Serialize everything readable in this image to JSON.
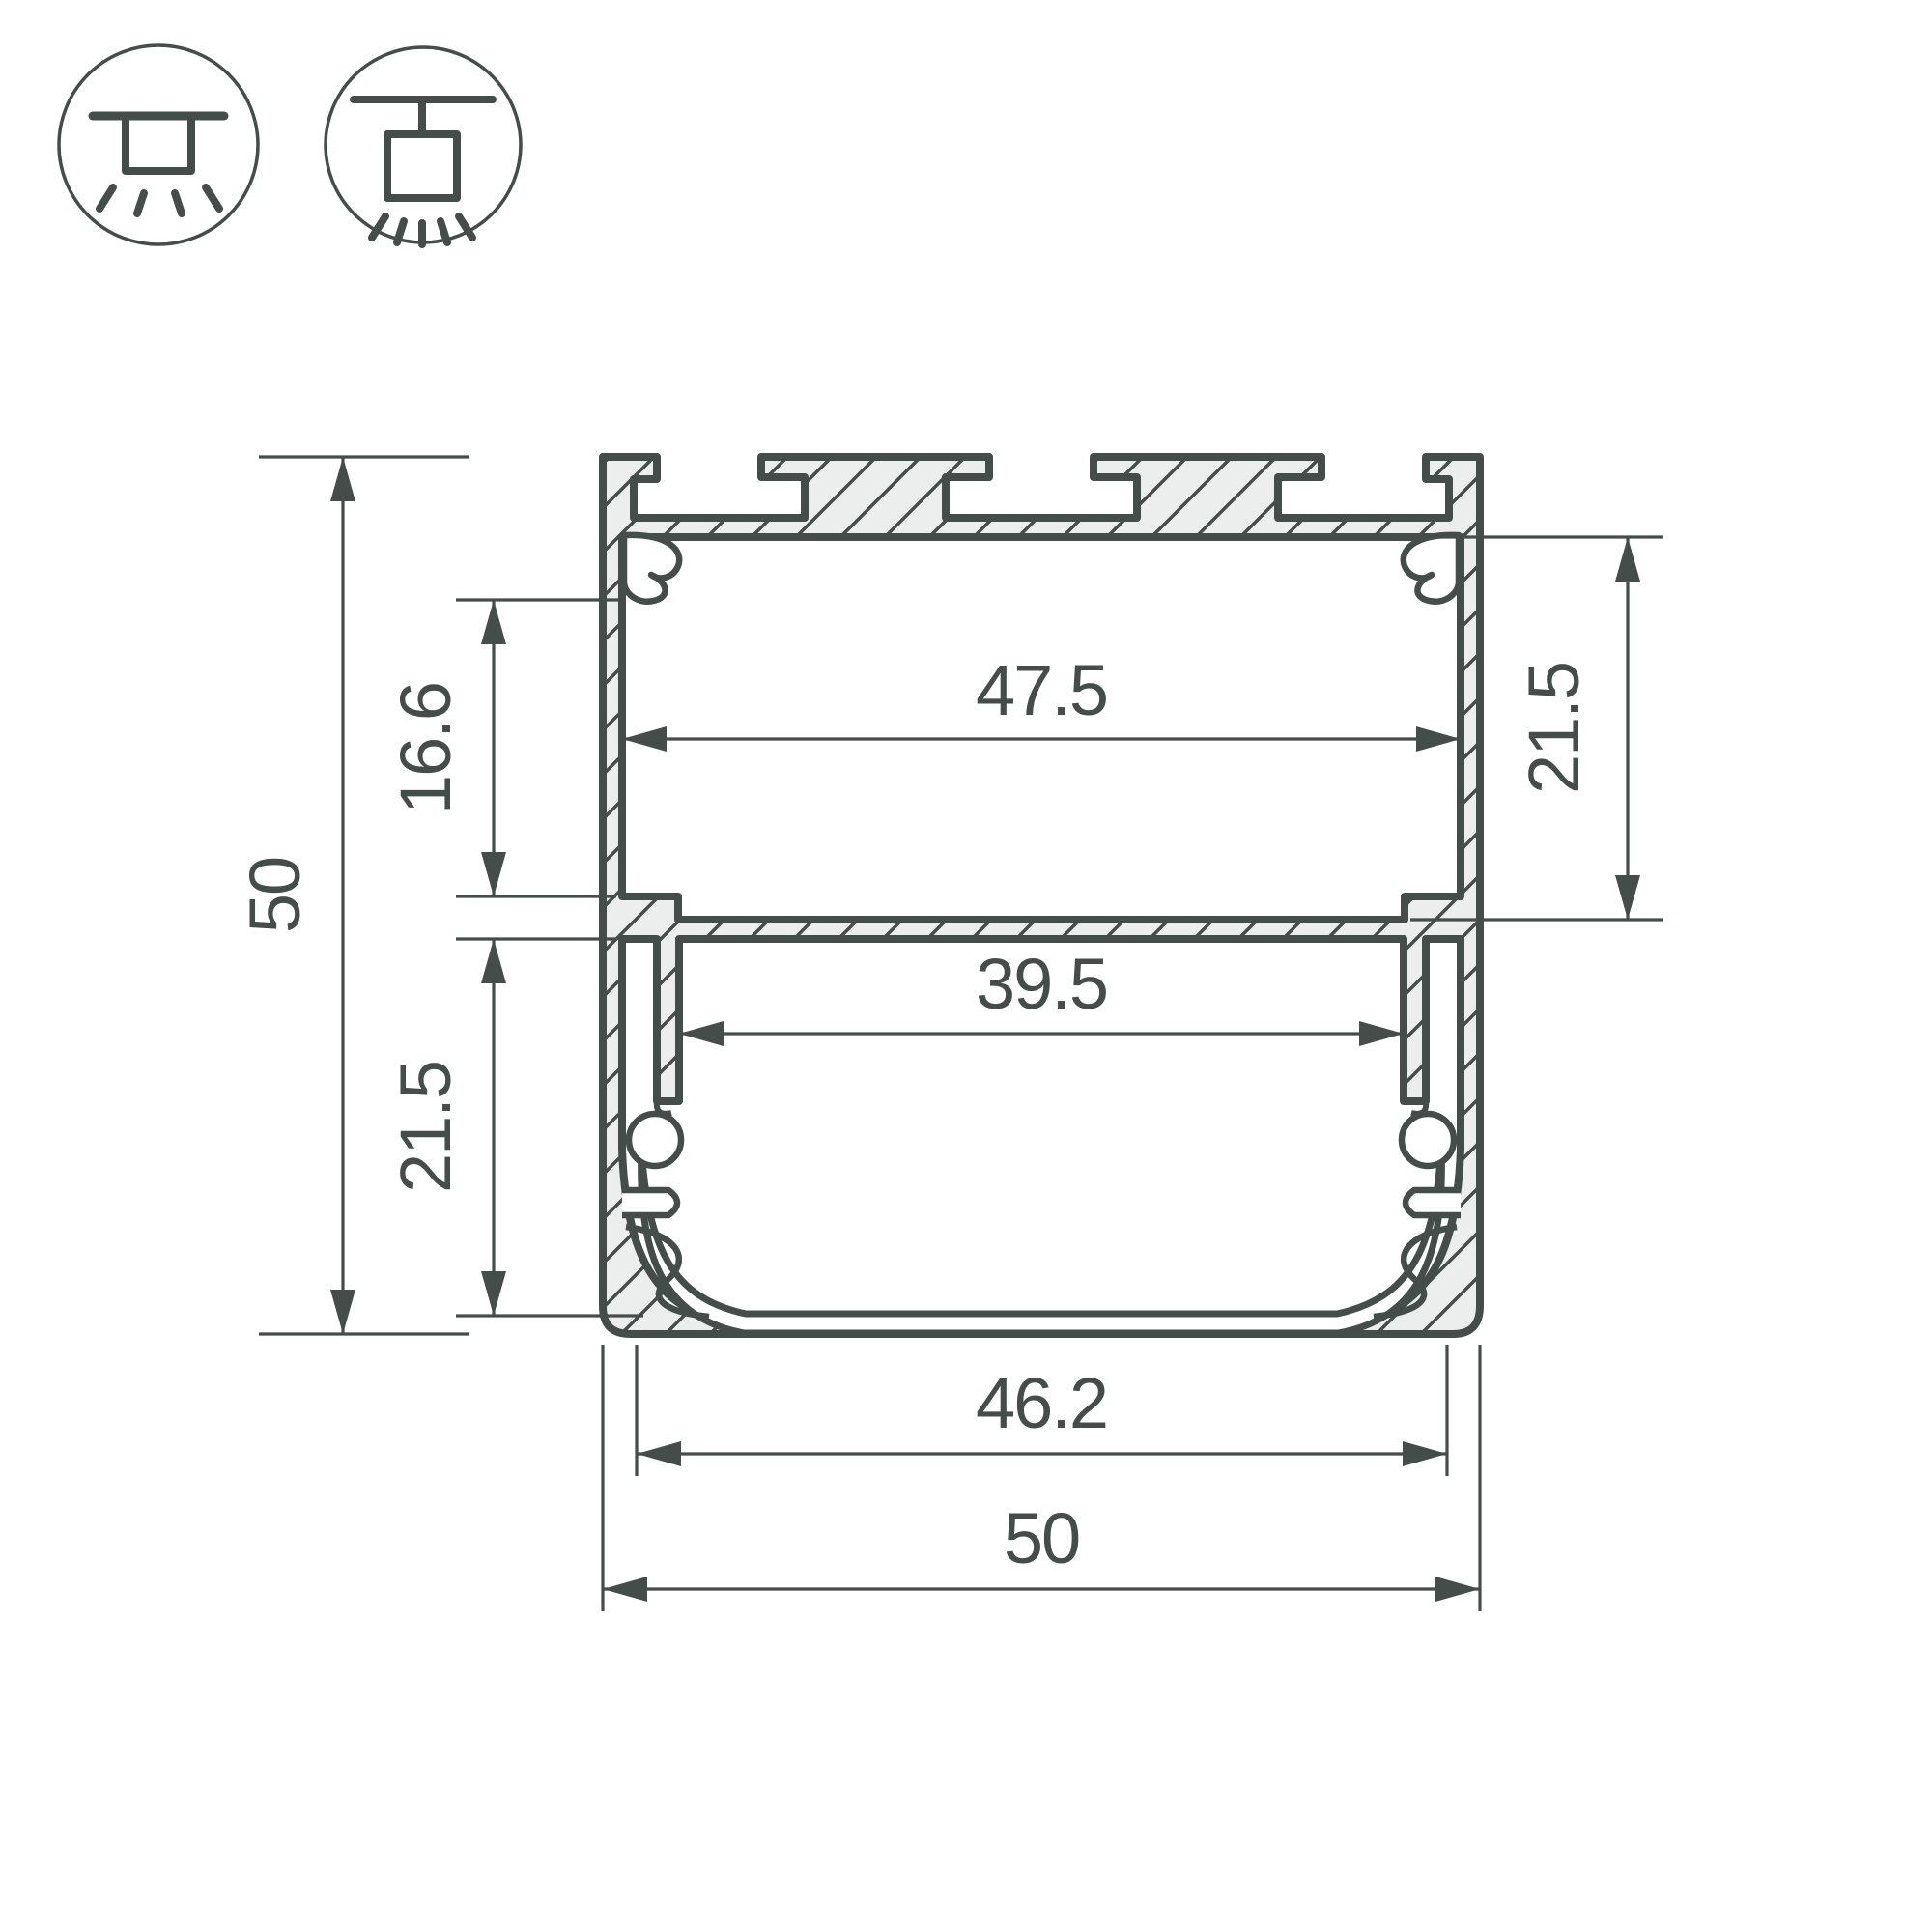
{
  "drawing": {
    "title": "LED profile cross-section technical drawing",
    "mount_icons": {
      "left": "surface-mounted-luminaire",
      "right": "suspended-luminaire"
    },
    "dimensions": {
      "height_overall": "50",
      "top_chamber_depth": "16.6",
      "bottom_chamber_depth": "21.5",
      "inner_width_top": "47.5",
      "upper_chamber_depth_right": "21.5",
      "inner_width_middle": "39.5",
      "inner_width_bottom": "46.2",
      "width_overall": "50"
    },
    "colors": {
      "line": "#454d4a",
      "metal_fill": "#eceeed",
      "background": "#ffffff"
    }
  }
}
